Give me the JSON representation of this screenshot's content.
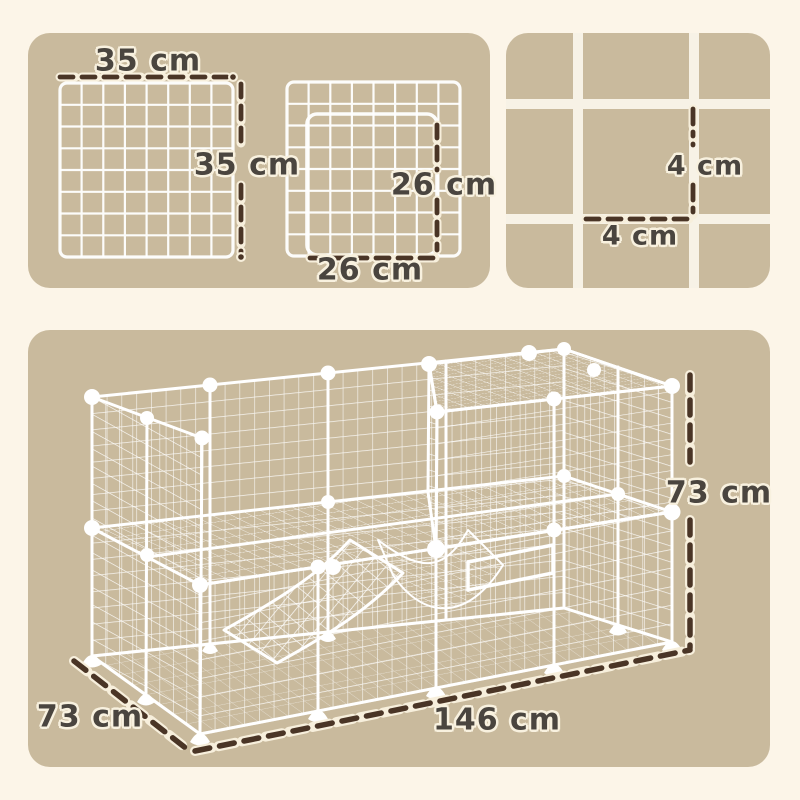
{
  "panel_small_grids": {
    "grid_width_label": "35 cm",
    "grid_height_label": "35 cm",
    "door_height_label": "26 cm",
    "door_width_label": "26 cm"
  },
  "panel_mesh_detail": {
    "mesh_cell_height_label": "4 cm",
    "mesh_cell_width_label": "4 cm"
  },
  "panel_cage": {
    "cage_height_label": "73 cm",
    "cage_length_label": "146 cm",
    "cage_depth_label": "73 cm"
  },
  "colors": {
    "page_background": "#FCF5E8",
    "panel_background": "#C9BA9D",
    "wire": "#FFFFFF",
    "dash_line": "#4A3526",
    "label_text": "#4A453F"
  }
}
